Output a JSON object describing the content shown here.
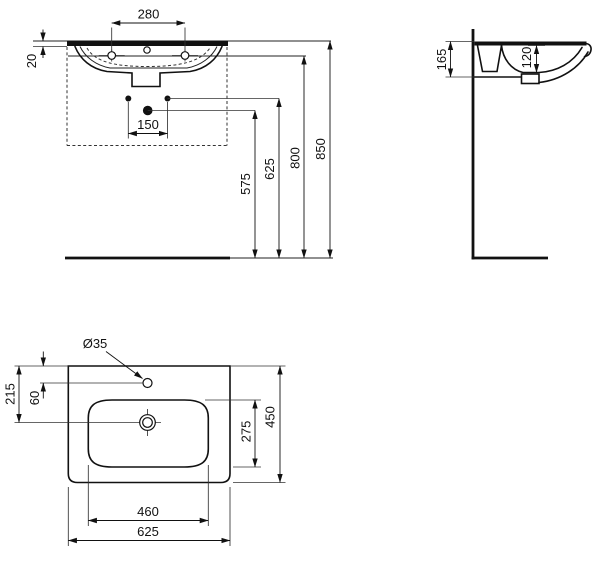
{
  "drawing": {
    "type": "washbasin installation technical drawing",
    "colors": {
      "line": "#111111",
      "background": "#ffffff"
    },
    "front_view": {
      "fixing_hole_spacing": "280",
      "rim_thickness": "20",
      "supply_spacing": "150",
      "waste_height": "575",
      "fixing_height": "625",
      "underside_height": "800",
      "rim_height": "850"
    },
    "side_view": {
      "basin_edge_depth": "165",
      "bowl_depth": "120"
    },
    "plan_view": {
      "tap_hole_diameter": "Ø35",
      "waste_from_back": "215",
      "tap_from_back": "60",
      "bowl_inner_depth": "275",
      "overall_depth": "450",
      "bowl_inner_width": "460",
      "overall_width": "625"
    }
  }
}
